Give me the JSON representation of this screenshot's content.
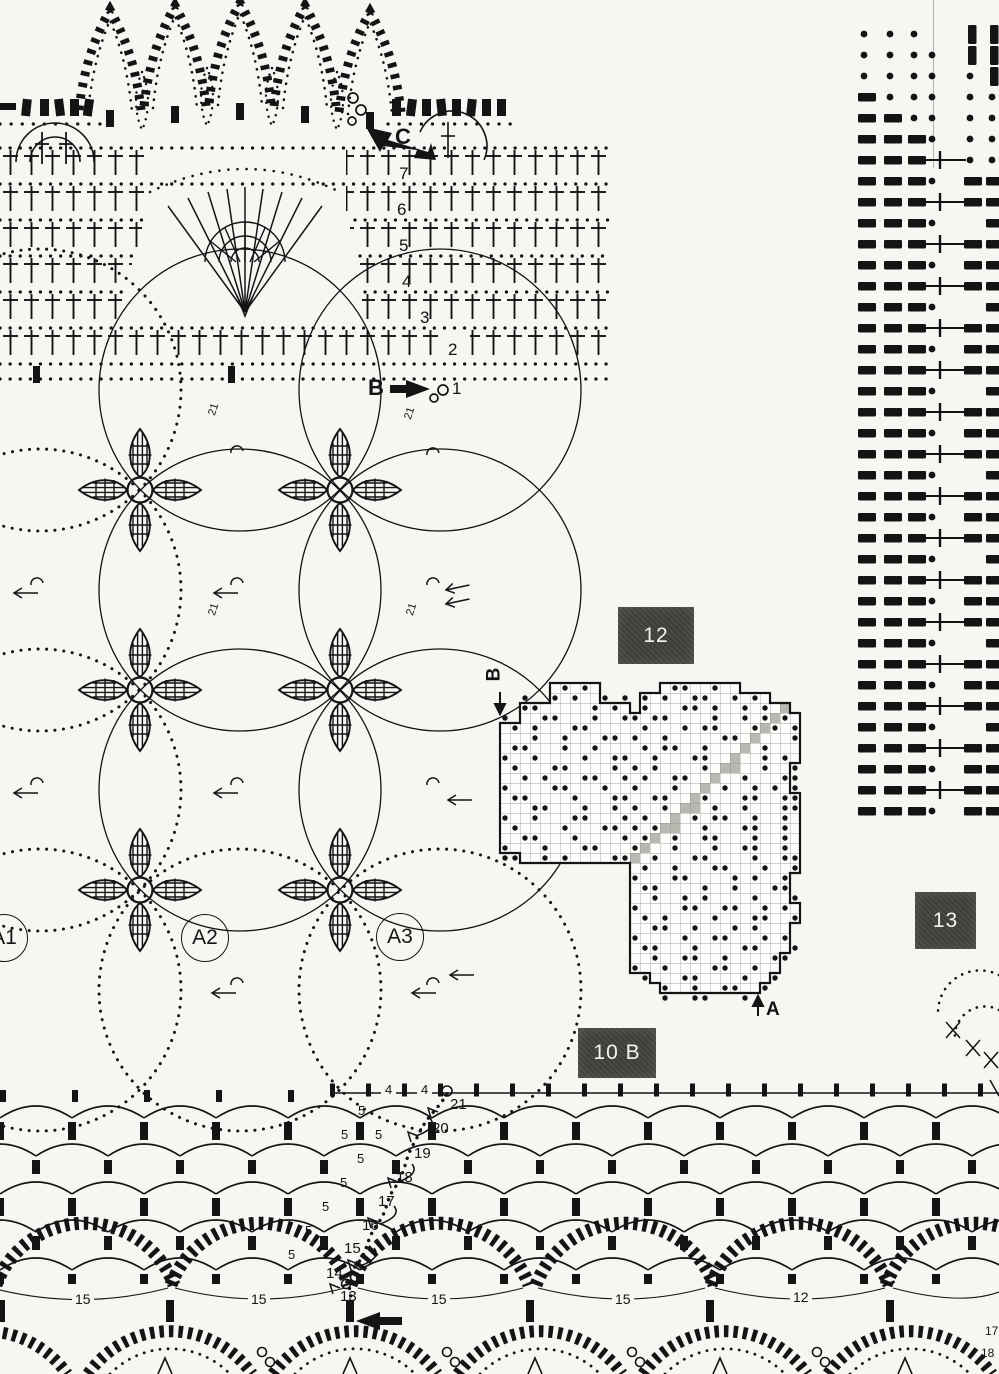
{
  "page": {
    "background": "#f6f6f3",
    "ink": "#141414",
    "shade": "#b9b9b2"
  },
  "edging": {
    "label_b": "B",
    "label_c": "C",
    "row_numbers": [
      "1",
      "2",
      "3",
      "4",
      "5",
      "6",
      "7"
    ]
  },
  "motifs": {
    "labels": [
      "A1",
      "A2",
      "A3"
    ],
    "turn_number": "21"
  },
  "filet": {
    "badge": "12",
    "point_b": "B",
    "point_a": "A",
    "legend": {
      "dot": "X",
      "gray": "g",
      "empty": "."
    },
    "rows": [
      "     .X.X.      .XX..X...     ",
      "  X..X.X..X.X X.X..XX..X.X..  ",
      "..XX.....X.X..X...XX.X..X.X.g.",
      "X...XX...X..XX.XX....X..X.XgX.",
      ".X.X...XX.....X...X.XX...XgX.X",
      "...X..X...XX.X..X.....XX.g...X",
      ".XX...X..X....X.XX..X...g.X...",
      "X..X....X..XX..X...XX..g..X.X.",
      ".X...XX....X.X.X....X.gg..X..X",
      "..X.X...XX..X.X..XX..g..X...XX",
      "X....XX...X..X...X..g.X..X.X.X",
      ".XX....X...XX..XX..gX...XX..XX",
      "...XX...X..X.X..X.gg.X..X...XX",
      "X..X...XX...X.X..g.X.XX..X..X.",
      ".X....X...XX.X.Xgg..X...XX..X.",
      "..XX...X....X.Xg.X..XX...X..X.",
      "X...X...XX...Xg..X...X..XX..X.",
      "XX..X.X....XXg.X...XX....X..XX",
      "             .X..X...XX...X..X",
      "             X...XX....X.X..X.",
      "             .XX....X..X...XX.",
      "             ..X..X.X....X...X",
      "             X....XX..XX..X.X.",
      "             .X.X....X...XX..X",
      "             ..XX..X...X.X....",
      "             X....X..XX...X.X.",
      "             .XX...X....XX...X",
      "             ..X..XX..X....XX.",
      "             X..X....XX..X....",
      "             .X...XX....X..X..",
      "               .X..X..XX..X.  ",
      "                X..XX...X..   "
    ]
  },
  "strip": {
    "badge": "13",
    "rows": [
      "... vv",
      "....vv",
      ".....v",
      "h.....",
      "hh....",
      "hhh...",
      "hhh+..",
      "hhh.hh",
      "hhh+hh",
      "hhh. h",
      "hhh+hh",
      "hhh.hh",
      "hhh+hh",
      "hhh. h",
      "hhh+hh",
      "hhh.hh",
      "hhh+hh",
      "hhh. h",
      "hhh+hh",
      "hhh.hh",
      "hhh+hh",
      "hhh. h",
      "hhh+hh",
      "hhh.hh",
      "hhh+hh",
      "hhh. h",
      "hhh+hh",
      "hhh.hh",
      "hhh+hh",
      "hhh. h",
      "hhh+hh",
      "hhh.hh",
      "hhh+hh",
      "hhh. h",
      "hhh+hh",
      "hhh.hh",
      "hhh+hh",
      "hhh.hh"
    ]
  },
  "bottom": {
    "badge": "10 B",
    "tick_labels_4": [
      "4",
      "4"
    ],
    "five": "5",
    "chain_numbers": [
      "21",
      "20",
      "19",
      "18",
      "17",
      "16",
      "15",
      "14",
      "13"
    ],
    "repeat_counts": [
      "15",
      "15",
      "15",
      "15",
      "12"
    ],
    "corner_numbers": [
      "17",
      "18"
    ]
  }
}
